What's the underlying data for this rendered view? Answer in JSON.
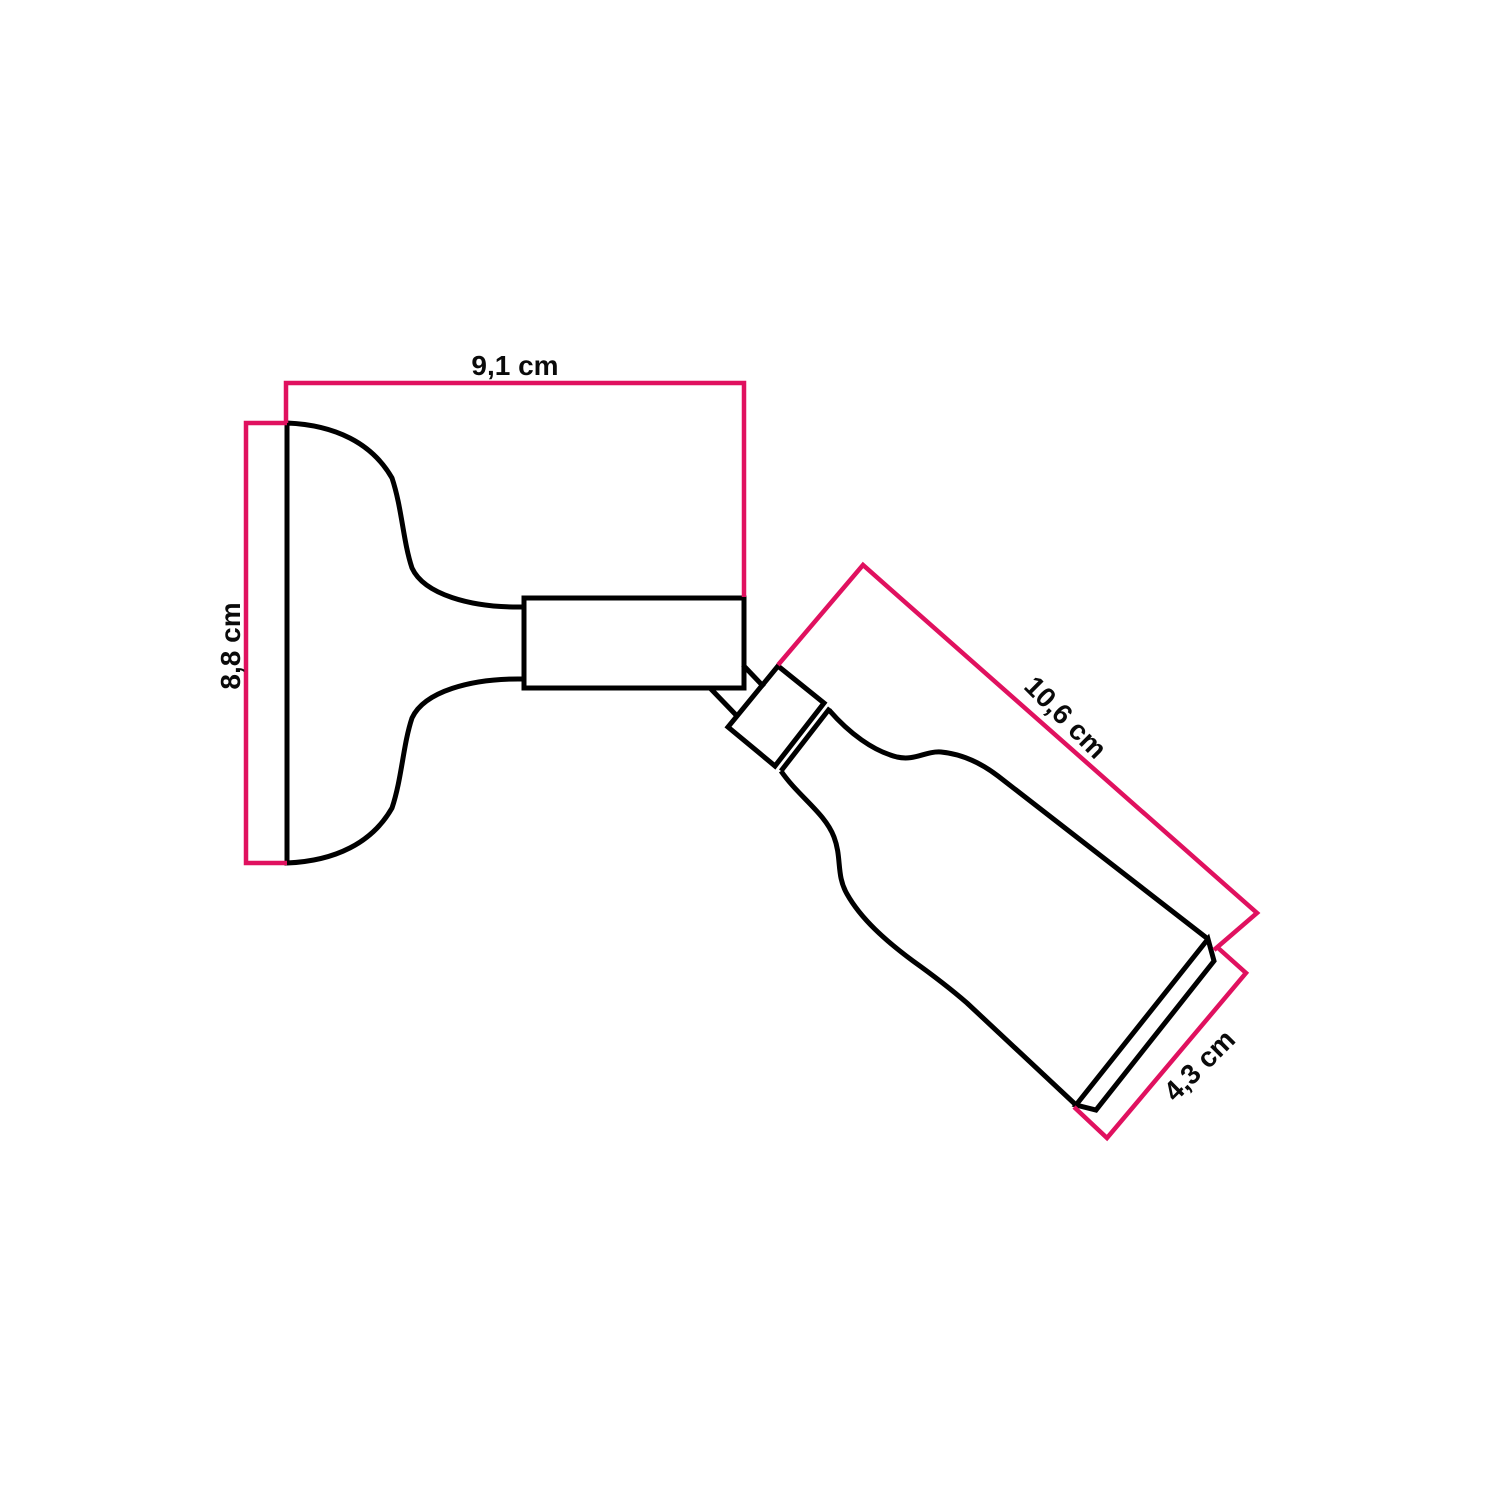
{
  "diagram": {
    "labels": {
      "width": "9,1 cm",
      "height": "8,8 cm",
      "length": "10,6 cm",
      "diameter": "4,3 cm"
    },
    "colors": {
      "dimension_line": "#e0115f",
      "outline": "#000000",
      "background": "#ffffff"
    }
  }
}
